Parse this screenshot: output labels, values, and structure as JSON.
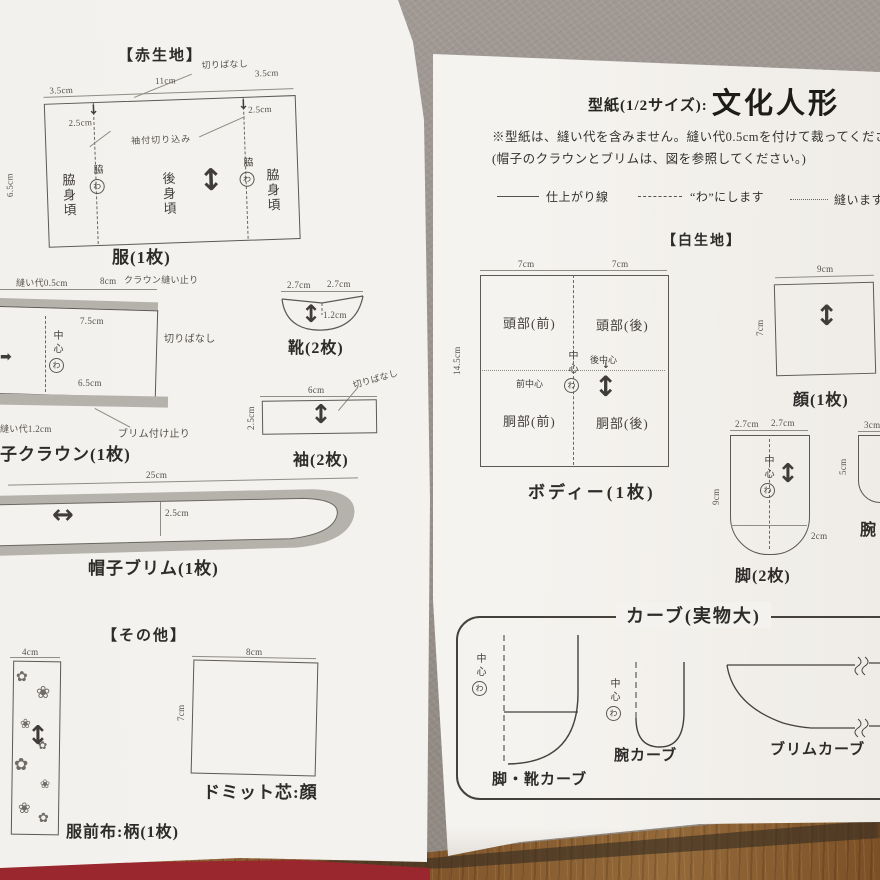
{
  "icons": {
    "grain_arrow_v": "↕",
    "grain_arrow_h": "↔",
    "fold_arrow_r": "➡",
    "slit_arrow": "↓",
    "small_down": "↓"
  },
  "left_page": {
    "section_red": "【赤生地】",
    "dress": {
      "caption": "服(1枚)",
      "kiribanashi": "切りばなし",
      "top_w_left": "3.5cm",
      "top_w_mid": "11cm",
      "top_w_right": "3.5cm",
      "notch_left": "2.5cm",
      "notch_right": "2.5cm",
      "notch_label": "袖付切り込み",
      "side_h": "6.5cm",
      "side_left": "脇身頃",
      "back_center": "後身頃",
      "side_right": "脇身頃",
      "fold_left": "脇",
      "fold_right": "脇",
      "wa": "わ"
    },
    "crown": {
      "caption": "帽子クラウン(1枚)",
      "seam_top": "縫い代0.5cm",
      "top_w": "8cm",
      "stop_label": "クラウン縫い止り",
      "w_75": "7.5cm",
      "kiribanashi": "切りばなし",
      "center": "中心",
      "wa": "わ",
      "w_65": "6.5cm",
      "seam_bottom": "縫い代1.2cm",
      "brim_stop": "ブリム付け止り"
    },
    "shoe": {
      "caption": "靴(2枚)",
      "w_left": "2.7cm",
      "w_right": "2.7cm",
      "h": "1.2cm"
    },
    "sleeve": {
      "caption": "袖(2枚)",
      "w": "6cm",
      "h": "2.5cm",
      "kiribanashi": "切りばなし"
    },
    "brim": {
      "caption": "帽子ブリム(1枚)",
      "w": "25cm",
      "h": "2.5cm"
    },
    "section_other": "【その他】",
    "front_cloth": {
      "caption": "服前布:柄(1枚)",
      "w": "4cm"
    },
    "domit": {
      "caption": "ドミット芯:顔",
      "w": "8cm",
      "h": "7cm"
    }
  },
  "right_page": {
    "title_prefix": "型紙(1/2サイズ):",
    "title_main": "文化人形",
    "note1": "※型紙は、縫い代を含みません。縫い代0.5cmを付けて裁ってください。",
    "note2": "(帽子のクラウンとブリムは、図を参照してください。)",
    "legend": {
      "finish": "仕上がり線",
      "fold": "“わ”にします",
      "sew": "縫います"
    },
    "section_white": "【白生地】",
    "body": {
      "caption": "ボディー(1枚)",
      "w_left": "7cm",
      "w_right": "7cm",
      "h": "14.5cm",
      "head_front": "頭部(前)",
      "head_back": "頭部(後)",
      "torso_front": "胴部(前)",
      "torso_back": "胴部(後)",
      "front_center": "前中心",
      "back_center": "後中心",
      "center": "中心",
      "wa": "わ"
    },
    "face": {
      "caption": "顔(1枚)",
      "w": "9cm",
      "h": "7cm"
    },
    "leg": {
      "caption": "脚(2枚)",
      "w_left": "2.7cm",
      "w_right": "2.7cm",
      "h": "9cm",
      "h2": "2cm",
      "center": "中心",
      "wa": "わ"
    },
    "arm": {
      "caption": "腕",
      "w": "3cm",
      "h": "5cm"
    },
    "curves": {
      "title": "カーブ(実物大)",
      "leg_shoe_caption": "脚・靴カーブ",
      "arm_caption": "腕カーブ",
      "brim_caption": "ブリムカーブ",
      "center": "中心",
      "wa": "わ"
    }
  }
}
